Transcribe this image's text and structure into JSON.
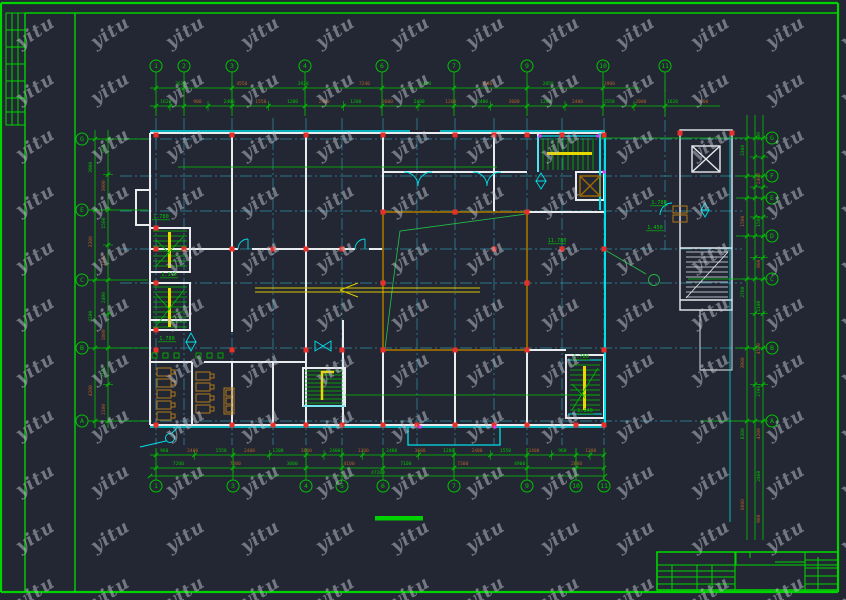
{
  "app": {
    "background": "#232733",
    "drawing_type_label": "yitu"
  },
  "colors": {
    "frame_green": "#00d400",
    "dim_green": "#00c400",
    "dim_brown": "#b0622a",
    "cyan": "#00e0ea",
    "teal_grid": "#2f93a8",
    "wall_white": "#e8ecef",
    "column_red": "#e8302a",
    "magenta": "#f030f0",
    "rail_yellow": "#e8d800",
    "hall_orange": "#9a6c00",
    "furniture_brown": "#b07818",
    "watermark": "rgba(195,200,210,0.5)"
  },
  "watermark": {
    "text": "yitu",
    "cols": 12,
    "rows": 11,
    "x0": 14,
    "y0": 42,
    "dx": 75,
    "dy": 56
  },
  "grid_bubbles": {
    "top": [
      {
        "label": "1",
        "x": 156
      },
      {
        "label": "2",
        "x": 184
      },
      {
        "label": "3",
        "x": 232
      },
      {
        "label": "4",
        "x": 305
      },
      {
        "label": "6",
        "x": 382
      },
      {
        "label": "7",
        "x": 454
      },
      {
        "label": "9",
        "x": 527
      },
      {
        "label": "10",
        "x": 603
      },
      {
        "label": "11",
        "x": 665
      }
    ],
    "bottom": [
      {
        "label": "1",
        "x": 156
      },
      {
        "label": "3",
        "x": 233
      },
      {
        "label": "4",
        "x": 306
      },
      {
        "label": "5",
        "x": 342
      },
      {
        "label": "6",
        "x": 383
      },
      {
        "label": "7",
        "x": 454
      },
      {
        "label": "9",
        "x": 527
      },
      {
        "label": "10",
        "x": 576
      },
      {
        "label": "11",
        "x": 604
      }
    ],
    "left": [
      {
        "label": "G",
        "y": 139
      },
      {
        "label": "E",
        "y": 210
      },
      {
        "label": "C",
        "y": 280
      },
      {
        "label": "B",
        "y": 348
      },
      {
        "label": "A",
        "y": 421
      }
    ],
    "right": [
      {
        "label": "G",
        "y": 138
      },
      {
        "label": "F",
        "y": 176
      },
      {
        "label": "E",
        "y": 198
      },
      {
        "label": "D",
        "y": 236
      },
      {
        "label": "C",
        "y": 279
      },
      {
        "label": "B",
        "y": 348
      },
      {
        "label": "A",
        "y": 421
      }
    ]
  },
  "dim_chains": {
    "top_outer": [
      "3620",
      "4550",
      "3920",
      "7240",
      "5480",
      "3600",
      "2850",
      "3900"
    ],
    "top_inner": [
      "1620",
      "900",
      "2400",
      "1550",
      "1200",
      "2400",
      "1200",
      "3600",
      "2400",
      "1200",
      "2400",
      "3600",
      "1200",
      "2400",
      "1550",
      "2000",
      "1620",
      "900"
    ],
    "bottom_inner": [
      "960",
      "2400",
      "1550",
      "2400",
      "1200",
      "3600",
      "2400",
      "1200",
      "2400",
      "3600",
      "1200",
      "2400",
      "1550",
      "2400",
      "960",
      "1200"
    ],
    "bottom_outer": [
      "7200",
      "7200",
      "3600",
      "4100",
      "7100",
      "7300",
      "4900",
      "2800"
    ],
    "bottom_total": "47200",
    "left_outer": [
      "3900",
      "3300",
      "4200",
      "4200"
    ],
    "left_inner": [
      "900",
      "3000",
      "1500",
      "1800",
      "2400",
      "1800",
      "2100",
      "2100"
    ],
    "right_outer": [
      "3300",
      "1500",
      "2700",
      "3900",
      "6300",
      "6600"
    ],
    "right_inner": [
      "900",
      "2400",
      "1500",
      "800",
      "2100",
      "4500",
      "2700",
      "4200",
      "2400",
      "900"
    ]
  },
  "elevation_labels": [
    {
      "text": "1.780",
      "x": 152,
      "y": 218
    },
    {
      "text": "1.140",
      "x": 160,
      "y": 276
    },
    {
      "text": "1.780",
      "x": 158,
      "y": 340
    },
    {
      "text": "11.780",
      "x": 548,
      "y": 242
    },
    {
      "text": "1.780",
      "x": 572,
      "y": 358
    },
    {
      "text": "1.140",
      "x": 576,
      "y": 412
    },
    {
      "text": "1.780",
      "x": 650,
      "y": 204
    },
    {
      "text": "1.450",
      "x": 646,
      "y": 229
    }
  ],
  "columns": [
    [
      156,
      135
    ],
    [
      232,
      135
    ],
    [
      306,
      135
    ],
    [
      383,
      135
    ],
    [
      455,
      135
    ],
    [
      494,
      135
    ],
    [
      527,
      135
    ],
    [
      562,
      135
    ],
    [
      604,
      135
    ],
    [
      383,
      212
    ],
    [
      455,
      212
    ],
    [
      527,
      212
    ],
    [
      156,
      249
    ],
    [
      184,
      249
    ],
    [
      232,
      249
    ],
    [
      273,
      249
    ],
    [
      306,
      249
    ],
    [
      342,
      249
    ],
    [
      494,
      249
    ],
    [
      562,
      249
    ],
    [
      604,
      249
    ],
    [
      383,
      283
    ],
    [
      527,
      283
    ],
    [
      156,
      350
    ],
    [
      232,
      350
    ],
    [
      306,
      350
    ],
    [
      342,
      350
    ],
    [
      383,
      350
    ],
    [
      455,
      350
    ],
    [
      527,
      350
    ],
    [
      604,
      350
    ],
    [
      156,
      425
    ],
    [
      232,
      425
    ],
    [
      273,
      425
    ],
    [
      306,
      425
    ],
    [
      342,
      425
    ],
    [
      383,
      425
    ],
    [
      417,
      425
    ],
    [
      455,
      425
    ],
    [
      494,
      425
    ],
    [
      527,
      425
    ],
    [
      576,
      425
    ],
    [
      604,
      425
    ],
    [
      680,
      133
    ],
    [
      732,
      133
    ],
    [
      156,
      228
    ],
    [
      156,
      283
    ],
    [
      156,
      330
    ]
  ],
  "magenta_dots": [
    [
      540,
      136
    ],
    [
      598,
      136
    ],
    [
      604,
      172
    ],
    [
      495,
      427
    ],
    [
      420,
      427
    ]
  ]
}
